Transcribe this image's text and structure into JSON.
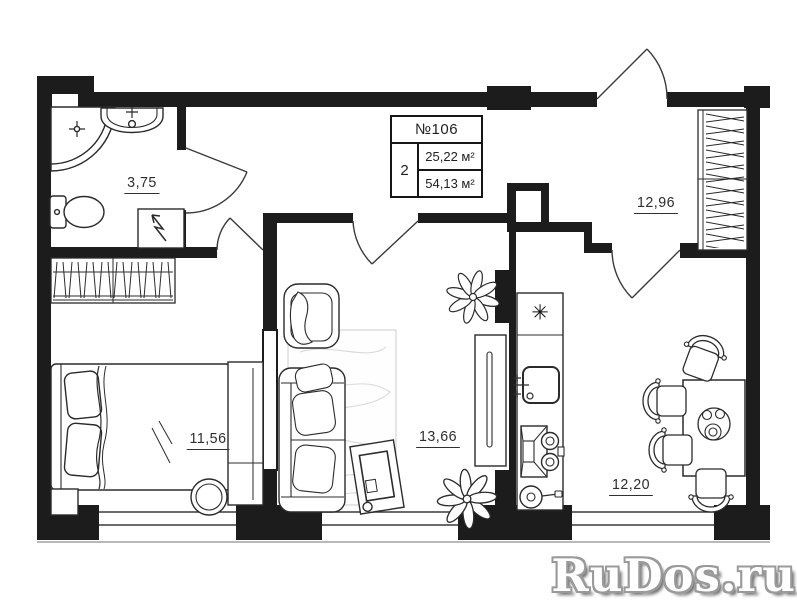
{
  "info_box": {
    "unit": "№106",
    "rooms_count": "2",
    "living_area": "25,22 м²",
    "total_area": "54,13 м²"
  },
  "room_labels": {
    "bathroom": "3,75",
    "bedroom": "11,56",
    "living_room": "13,66",
    "hall": "12,96",
    "kitchen": "12,20"
  },
  "symbols": {
    "fridge": "✳"
  },
  "watermark": {
    "text": "RuDos.ru"
  },
  "colors": {
    "wall": "#1c1c1c",
    "outline": "#2b2b2b",
    "rug_line": "#d9d9d9",
    "watermark_fill": "#ffffff",
    "watermark_outline": "#9a9a9a"
  }
}
